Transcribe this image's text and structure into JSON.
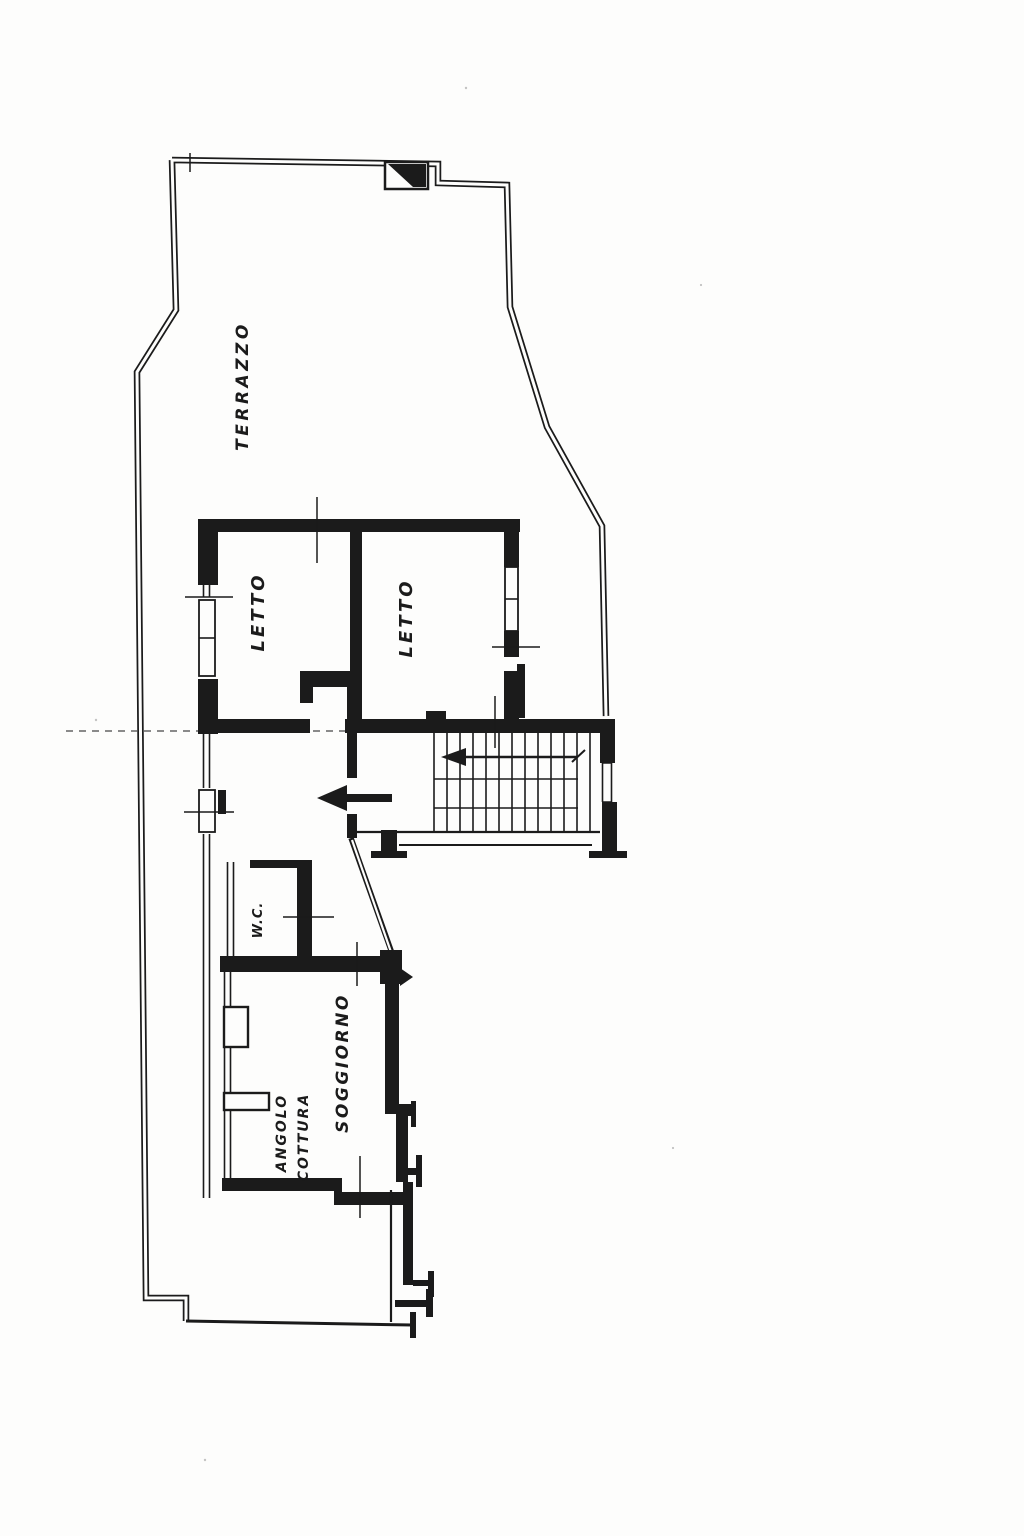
{
  "colors": {
    "ink": "#1b1b1b",
    "paper": "#fdfdfc"
  },
  "plan": {
    "labels": {
      "terrace": "TERRAZZO",
      "bedroom_left": "LETTO",
      "bedroom_right": "LETTO",
      "wc": "W.C.",
      "living_room": "SOGGIORNO",
      "kitchenette_line1": "ANGOLO",
      "kitchenette_line2": "COTTURA"
    }
  }
}
